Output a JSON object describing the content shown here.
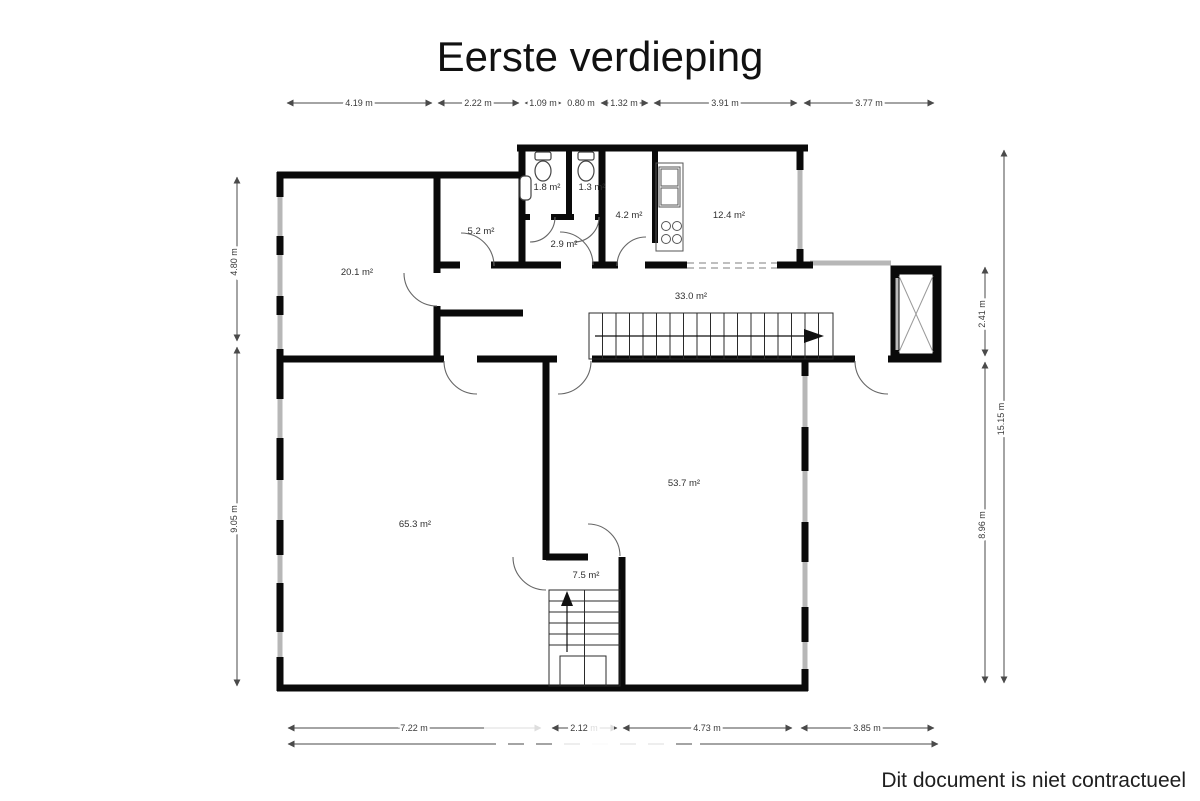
{
  "title": "Eerste verdieping",
  "disclaimer": "Dit document is niet contractueel",
  "rooms": [
    "20.1 m²",
    "5.2 m²",
    "1.8 m²",
    "1.3 m²",
    "2.9 m²",
    "4.2 m²",
    "12.4 m²",
    "33.0 m²",
    "65.3 m²",
    "53.7 m²",
    "7.5 m²"
  ],
  "dimensions": {
    "top": [
      "4.19 m",
      "2.22 m",
      "1.09 m",
      "0.80 m",
      "1.32 m",
      "3.91 m",
      "3.77 m"
    ],
    "left": [
      "4.80 m",
      "9.05 m"
    ],
    "right": [
      "2.41 m",
      "8.96 m"
    ],
    "right_total": "15.15 m",
    "bottom": [
      "7.22 m",
      "2.12 m",
      "4.73 m",
      "3.85 m"
    ]
  },
  "colors": {
    "wall": "#0a0a0a",
    "window": "#b7b7b7",
    "dimension": "#4a4a4a"
  }
}
